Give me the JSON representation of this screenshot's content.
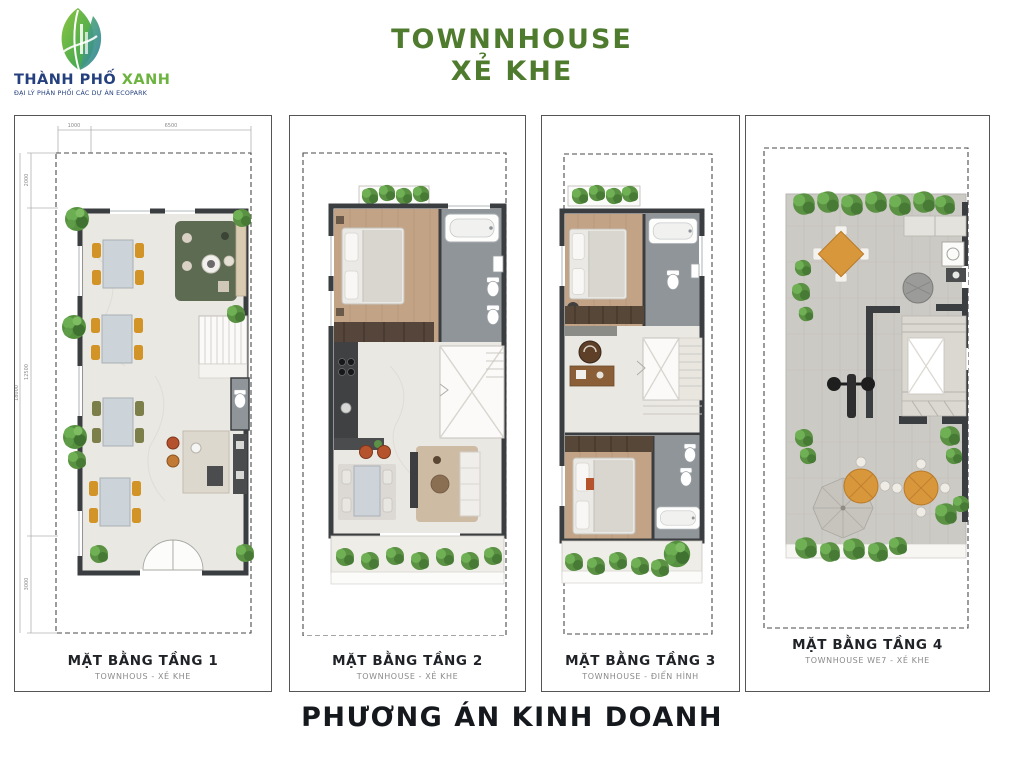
{
  "header": {
    "logo": {
      "name_primary": "THÀNH PHỐ",
      "name_accent": "XANH",
      "subtitle": "ĐẠI LÝ PHÂN PHỐI CÁC DỰ ÁN ECOPARK"
    },
    "title_line1": "TOWNNHOUSE",
    "title_line2": "XẺ KHE"
  },
  "panels": [
    {
      "caption": "MẶT BẰNG TẦNG 1",
      "subcaption": "TOWNHOUS - XẺ KHE"
    },
    {
      "caption": "MẶT BẰNG TẦNG 2",
      "subcaption": "TOWNHOUSE - XẺ KHE"
    },
    {
      "caption": "MẶT BẰNG TẦNG 3",
      "subcaption": "TOWNHOUSE - ĐIỂN HÌNH"
    },
    {
      "caption": "MẶT BẰNG TẦNG 4",
      "subcaption": "TOWNHOUSE WE7 - XẺ KHE"
    }
  ],
  "dimensions": {
    "top_seg1": "1000",
    "top_seg2": "6500",
    "left_seg1": "2000",
    "left_seg2": "12500",
    "left_seg3": "3000",
    "left_total": "18000"
  },
  "footer": {
    "title": "PHƯƠNG ÁN KINH DOANH"
  },
  "colors": {
    "title_green": "#4e7b2d",
    "logo_navy": "#24407e",
    "logo_green": "#6cb33f",
    "caption_dark": "#1f2226",
    "footer_dark": "#15181c"
  }
}
